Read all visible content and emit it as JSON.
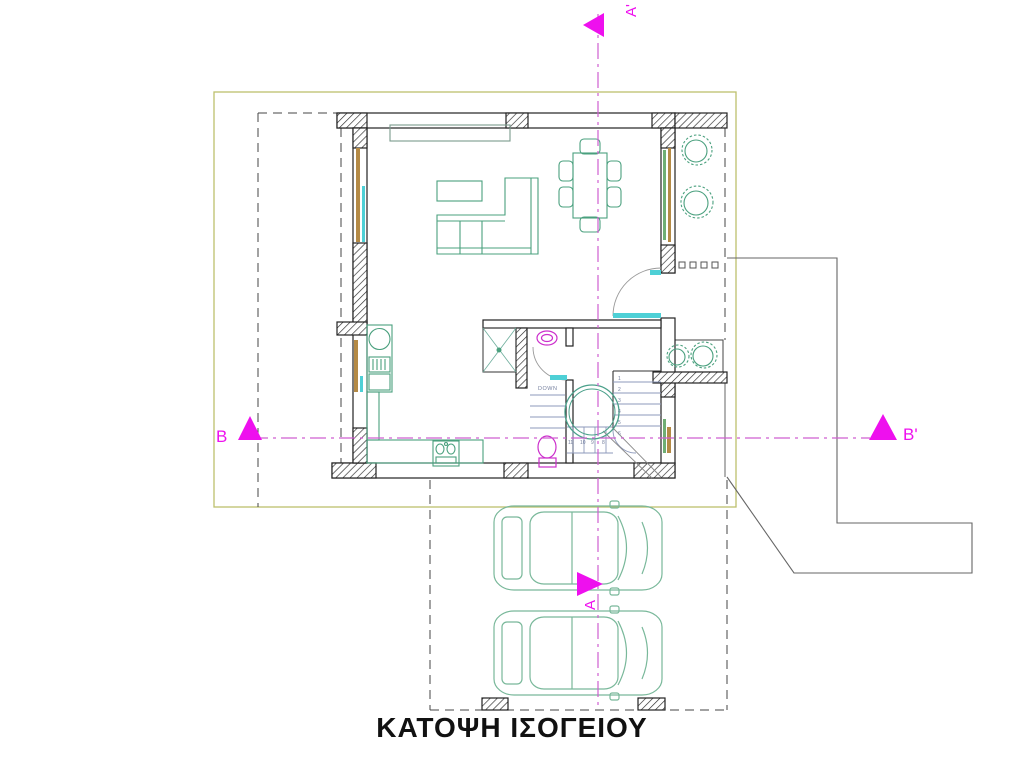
{
  "title": "ΚΑΤΟΨΗ ΙΣΟΓΕΙΟΥ",
  "section_markers": {
    "top": "A'",
    "bottom": "A",
    "left": "B",
    "right": "B'"
  },
  "labels": {
    "stair_down": "DOWN"
  },
  "stairs": {
    "upper_run_numbers": [
      "1",
      "2",
      "3",
      "4",
      "5",
      "6"
    ],
    "lower_run_numbers": [
      "11",
      "10",
      "9",
      "8"
    ]
  },
  "colors": {
    "section_marker": "#ee10ee",
    "section_line": "#cf5fd0",
    "wall": "#222222",
    "furniture": "#4aa07e",
    "car": "#79b89a",
    "door": "#4ed0d6",
    "window_frame": "#b48a46",
    "window_glass": "#4ed0d6",
    "window_green": "#6fae74",
    "property_line": "#bdbf6d",
    "boundary": "#666666",
    "fixture": "#cc2fcc",
    "stair_line": "#8d99bb",
    "stair_text": "#76809f",
    "swing_arc": "#9a9a9a"
  }
}
